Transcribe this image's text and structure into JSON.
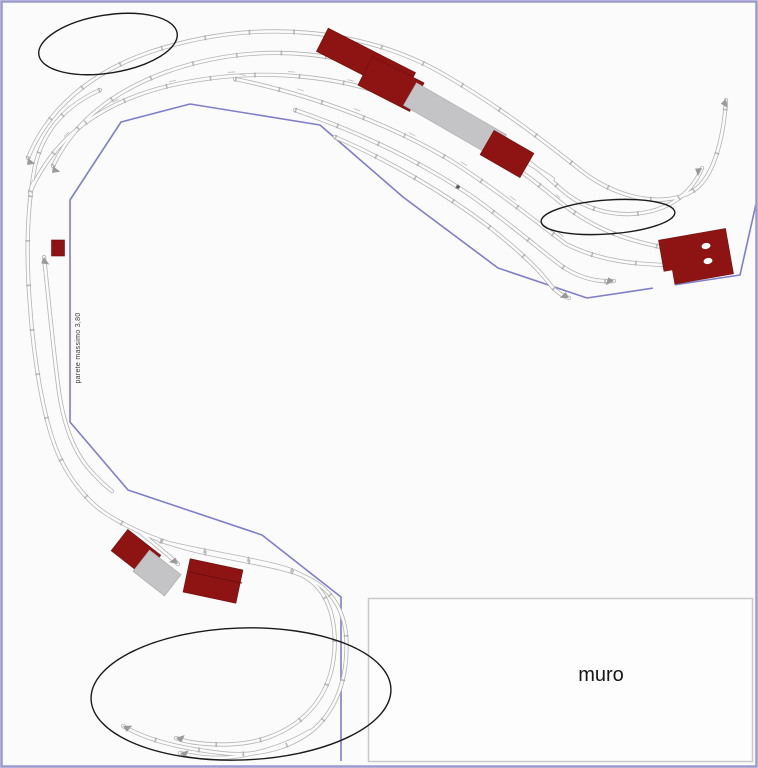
{
  "plan": {
    "wall_label": "muro",
    "wall_note": "parete massimo 3,80",
    "colors": {
      "background": "#fbfbfb",
      "page_border": "#9a9ace",
      "table_edge": "#7e7ec9",
      "track": "#b4b4b4",
      "building": "#8e1313",
      "platform": "#c4c4c6",
      "annotation_outline": "#1a1a1a",
      "wall_box_border": "#c9c9c9"
    },
    "annotations": [
      {
        "name": "ellipse-top-left"
      },
      {
        "name": "ellipse-right"
      },
      {
        "name": "ellipse-bottom"
      }
    ],
    "buildings": [
      {
        "name": "station-building-top"
      },
      {
        "name": "platform-top"
      },
      {
        "name": "goods-shed-top"
      },
      {
        "name": "signal-hut-left"
      },
      {
        "name": "halt-building-bottom-red"
      },
      {
        "name": "halt-platform-bottom-gray"
      },
      {
        "name": "warehouse-bottom"
      },
      {
        "name": "engine-shed-right"
      }
    ]
  }
}
